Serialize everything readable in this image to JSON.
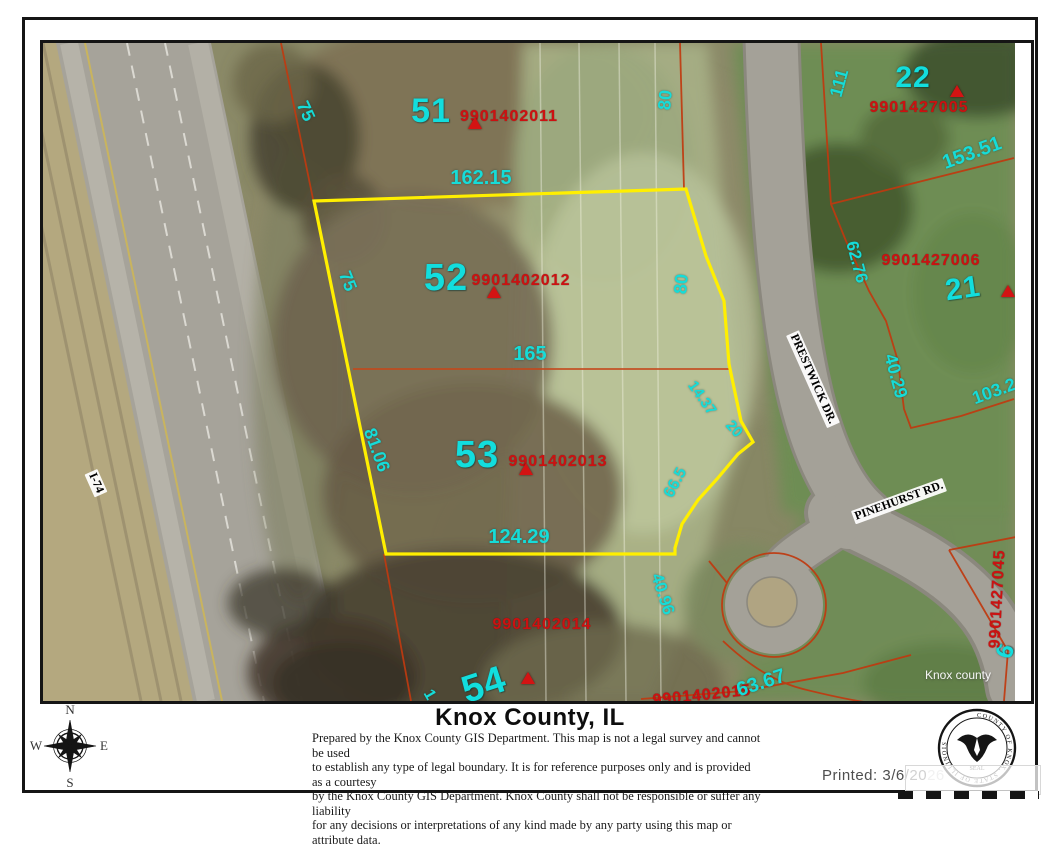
{
  "map": {
    "watermark": {
      "text": "Knox county",
      "x": 915,
      "y": 632
    },
    "streets": [
      {
        "text": "PRESTWICK DR.",
        "x": 770,
        "y": 336,
        "rot": 66,
        "size": 12
      },
      {
        "text": "PINEHURST RD.",
        "x": 856,
        "y": 458,
        "rot": -20,
        "size": 12
      },
      {
        "text": "I-74",
        "x": 53,
        "y": 440,
        "rot": 66,
        "size": 12
      }
    ],
    "parcel_numbers": [
      {
        "text": "51",
        "x": 388,
        "y": 68,
        "rot": 0,
        "size": 34
      },
      {
        "text": "52",
        "x": 403,
        "y": 235,
        "rot": 0,
        "size": 38
      },
      {
        "text": "53",
        "x": 434,
        "y": 412,
        "rot": 0,
        "size": 38
      },
      {
        "text": "54",
        "x": 441,
        "y": 642,
        "rot": -18,
        "size": 38
      },
      {
        "text": "22",
        "x": 870,
        "y": 35,
        "rot": 0,
        "size": 30
      },
      {
        "text": "21",
        "x": 920,
        "y": 246,
        "rot": -8,
        "size": 30
      },
      {
        "text": "6",
        "x": 963,
        "y": 608,
        "rot": -70,
        "size": 24
      }
    ],
    "parcel_ids": [
      {
        "text": "9901402011",
        "x": 466,
        "y": 74,
        "rot": 0
      },
      {
        "text": "9901402012",
        "x": 478,
        "y": 238,
        "rot": 0
      },
      {
        "text": "9901402013",
        "x": 515,
        "y": 419,
        "rot": 0
      },
      {
        "text": "9901402014",
        "x": 499,
        "y": 582,
        "rot": 0
      },
      {
        "text": "9901402015",
        "x": 659,
        "y": 653,
        "rot": -6
      },
      {
        "text": "9901427005",
        "x": 876,
        "y": 65,
        "rot": 0
      },
      {
        "text": "9901427006",
        "x": 888,
        "y": 218,
        "rot": 0
      },
      {
        "text": "9901427045",
        "x": 955,
        "y": 556,
        "rot": -87
      }
    ],
    "dimensions": [
      {
        "text": "75",
        "x": 263,
        "y": 68,
        "rot": 65,
        "size": 18
      },
      {
        "text": "162.15",
        "x": 438,
        "y": 135,
        "rot": 0,
        "size": 20
      },
      {
        "text": "80",
        "x": 622,
        "y": 57,
        "rot": -85,
        "size": 18
      },
      {
        "text": "111",
        "x": 796,
        "y": 40,
        "rot": -75,
        "size": 18
      },
      {
        "text": "153.51",
        "x": 929,
        "y": 110,
        "rot": -20,
        "size": 20
      },
      {
        "text": "62.76",
        "x": 814,
        "y": 219,
        "rot": 75,
        "size": 17
      },
      {
        "text": "75",
        "x": 305,
        "y": 238,
        "rot": 68,
        "size": 18
      },
      {
        "text": "80",
        "x": 638,
        "y": 241,
        "rot": -85,
        "size": 18
      },
      {
        "text": "165",
        "x": 487,
        "y": 311,
        "rot": 0,
        "size": 20
      },
      {
        "text": "14.37",
        "x": 659,
        "y": 355,
        "rot": 55,
        "size": 15
      },
      {
        "text": "20",
        "x": 691,
        "y": 386,
        "rot": 48,
        "size": 15
      },
      {
        "text": "81.06",
        "x": 334,
        "y": 407,
        "rot": 70,
        "size": 18
      },
      {
        "text": "66.5",
        "x": 633,
        "y": 440,
        "rot": -62,
        "size": 16
      },
      {
        "text": "124.29",
        "x": 476,
        "y": 494,
        "rot": 0,
        "size": 20
      },
      {
        "text": "40.29",
        "x": 853,
        "y": 333,
        "rot": 75,
        "size": 18
      },
      {
        "text": "103.2",
        "x": 951,
        "y": 348,
        "rot": -20,
        "size": 18
      },
      {
        "text": "40.96",
        "x": 620,
        "y": 551,
        "rot": 72,
        "size": 17
      },
      {
        "text": "63.67",
        "x": 718,
        "y": 640,
        "rot": -18,
        "size": 20
      },
      {
        "text": "1",
        "x": 386,
        "y": 652,
        "rot": 60,
        "size": 16
      }
    ],
    "markers": [
      {
        "x": 432,
        "y": 80
      },
      {
        "x": 451,
        "y": 249
      },
      {
        "x": 483,
        "y": 426
      },
      {
        "x": 485,
        "y": 635
      },
      {
        "x": 914,
        "y": 48
      },
      {
        "x": 965,
        "y": 248
      }
    ],
    "colors": {
      "highlight_boundary": "#ffef00",
      "parcel_line": "#c0390f",
      "dimension_text": "#16dcd8",
      "parcel_id_text": "#cc1111"
    }
  },
  "footer": {
    "title": "Knox County, IL",
    "disclaimer_lines": [
      "Prepared by the Knox County GIS Department. This map is not a legal survey and cannot be used",
      "to establish any type of legal boundary. It is for reference purposes only and is provided as a courtesy",
      "by the Knox County GIS Department.  Knox County shall not be responsible or suffer any liability",
      "for any decisions or interpretations of any kind made by any party using this map or attribute data."
    ],
    "printed_prefix": "Printed: 3/6/20",
    "printed_suffix": "26",
    "compass": {
      "north": "N",
      "south": "S",
      "east": "E",
      "west": "W"
    },
    "seal": {
      "ring_text": "COUNTY OF KNOX, STATE OF ILLINOIS",
      "label": "SEAL"
    }
  }
}
